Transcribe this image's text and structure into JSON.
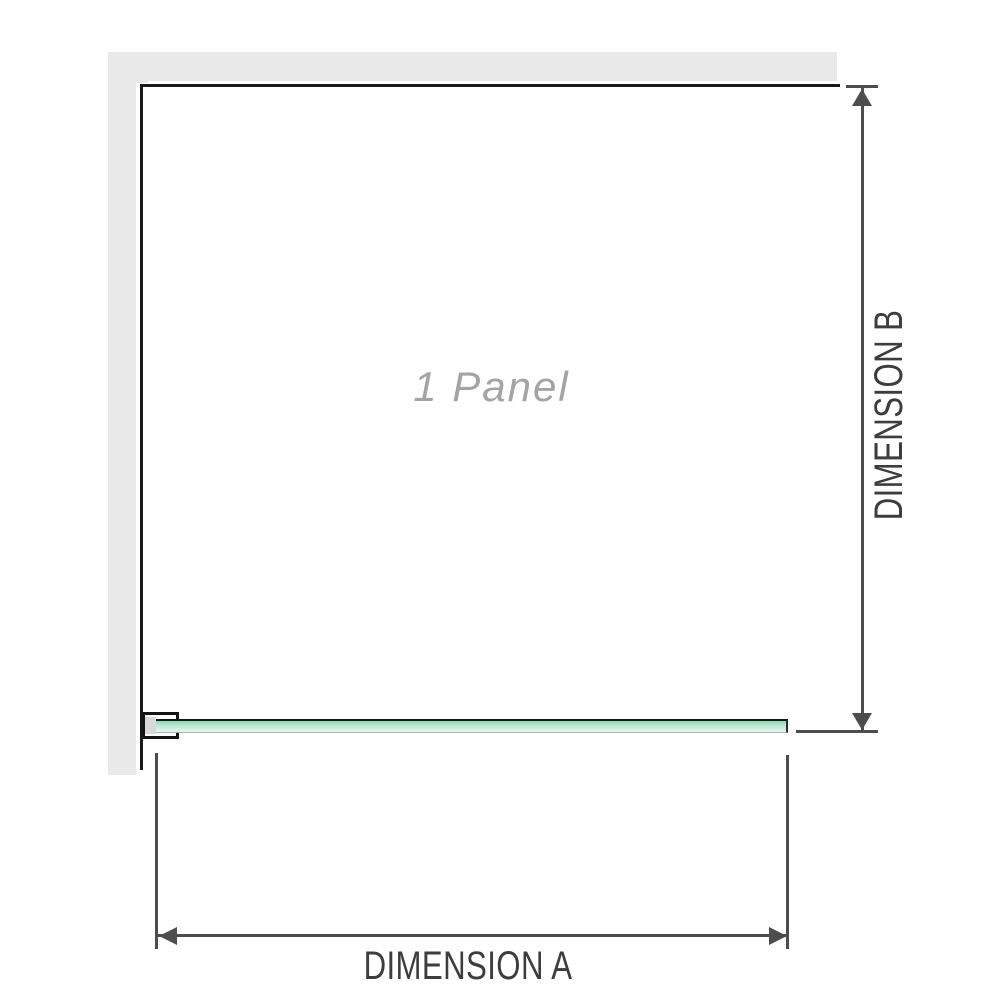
{
  "diagram": {
    "panel": {
      "label": "1 Panel"
    },
    "dim_a": {
      "label": "DIMENSION A"
    },
    "dim_b": {
      "label": "DIMENSION B"
    },
    "colors": {
      "wall": "#e9e9e9",
      "panel_border": "#1a1a1a",
      "dim_line": "#4d4d4d",
      "dim_text": "#3d3d3d",
      "panel_text": "#a4a4a4",
      "glass_top": "#8fd8b4",
      "glass_bottom": "#e9f7f0",
      "bracket_pad": "#d9d9d9"
    }
  }
}
